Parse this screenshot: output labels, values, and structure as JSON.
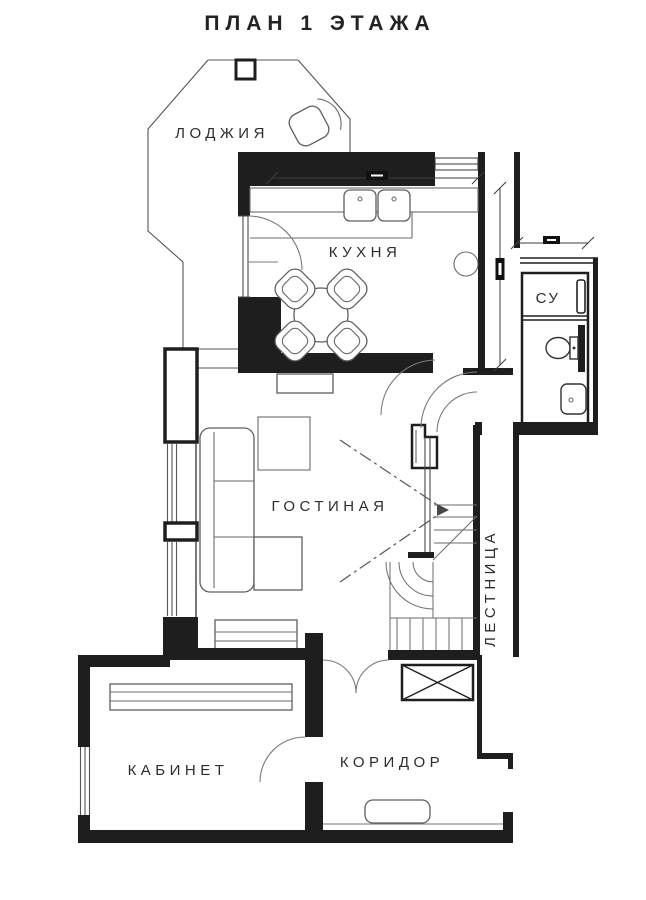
{
  "title": "ПЛАН 1 ЭТАЖА",
  "rooms": {
    "loggia": {
      "label": "ЛОДЖИЯ"
    },
    "kitchen": {
      "label": "КУХНЯ"
    },
    "bathroom": {
      "label": "СУ"
    },
    "living_room": {
      "label": "ГОСТИНАЯ"
    },
    "staircase": {
      "label": "ЛЕСТНИЦА"
    },
    "office": {
      "label": "КАБИНЕТ"
    },
    "corridor": {
      "label": "КОРИДОР"
    }
  },
  "furniture_icons": [
    "loggia-chair-icon",
    "kitchen-counter-icon",
    "double-sink-icon",
    "boiler-icon",
    "dining-table-icon",
    "dining-chair-icon",
    "corner-sofa-icon",
    "side-table-icon",
    "tv-stand-icon",
    "sideboard-icon",
    "wardrobe-icon",
    "toilet-icon",
    "wash-basin-icon",
    "towel-radiator-icon",
    "bench-icon",
    "stairs-icon",
    "under-stair-storage-icon",
    "door-arc-icon",
    "dimension-line-icon"
  ],
  "colors": {
    "background": "#ffffff",
    "wall": "#1e1e1e",
    "furniture_line": "#5f5f5f",
    "text": "#2d2d2d"
  }
}
